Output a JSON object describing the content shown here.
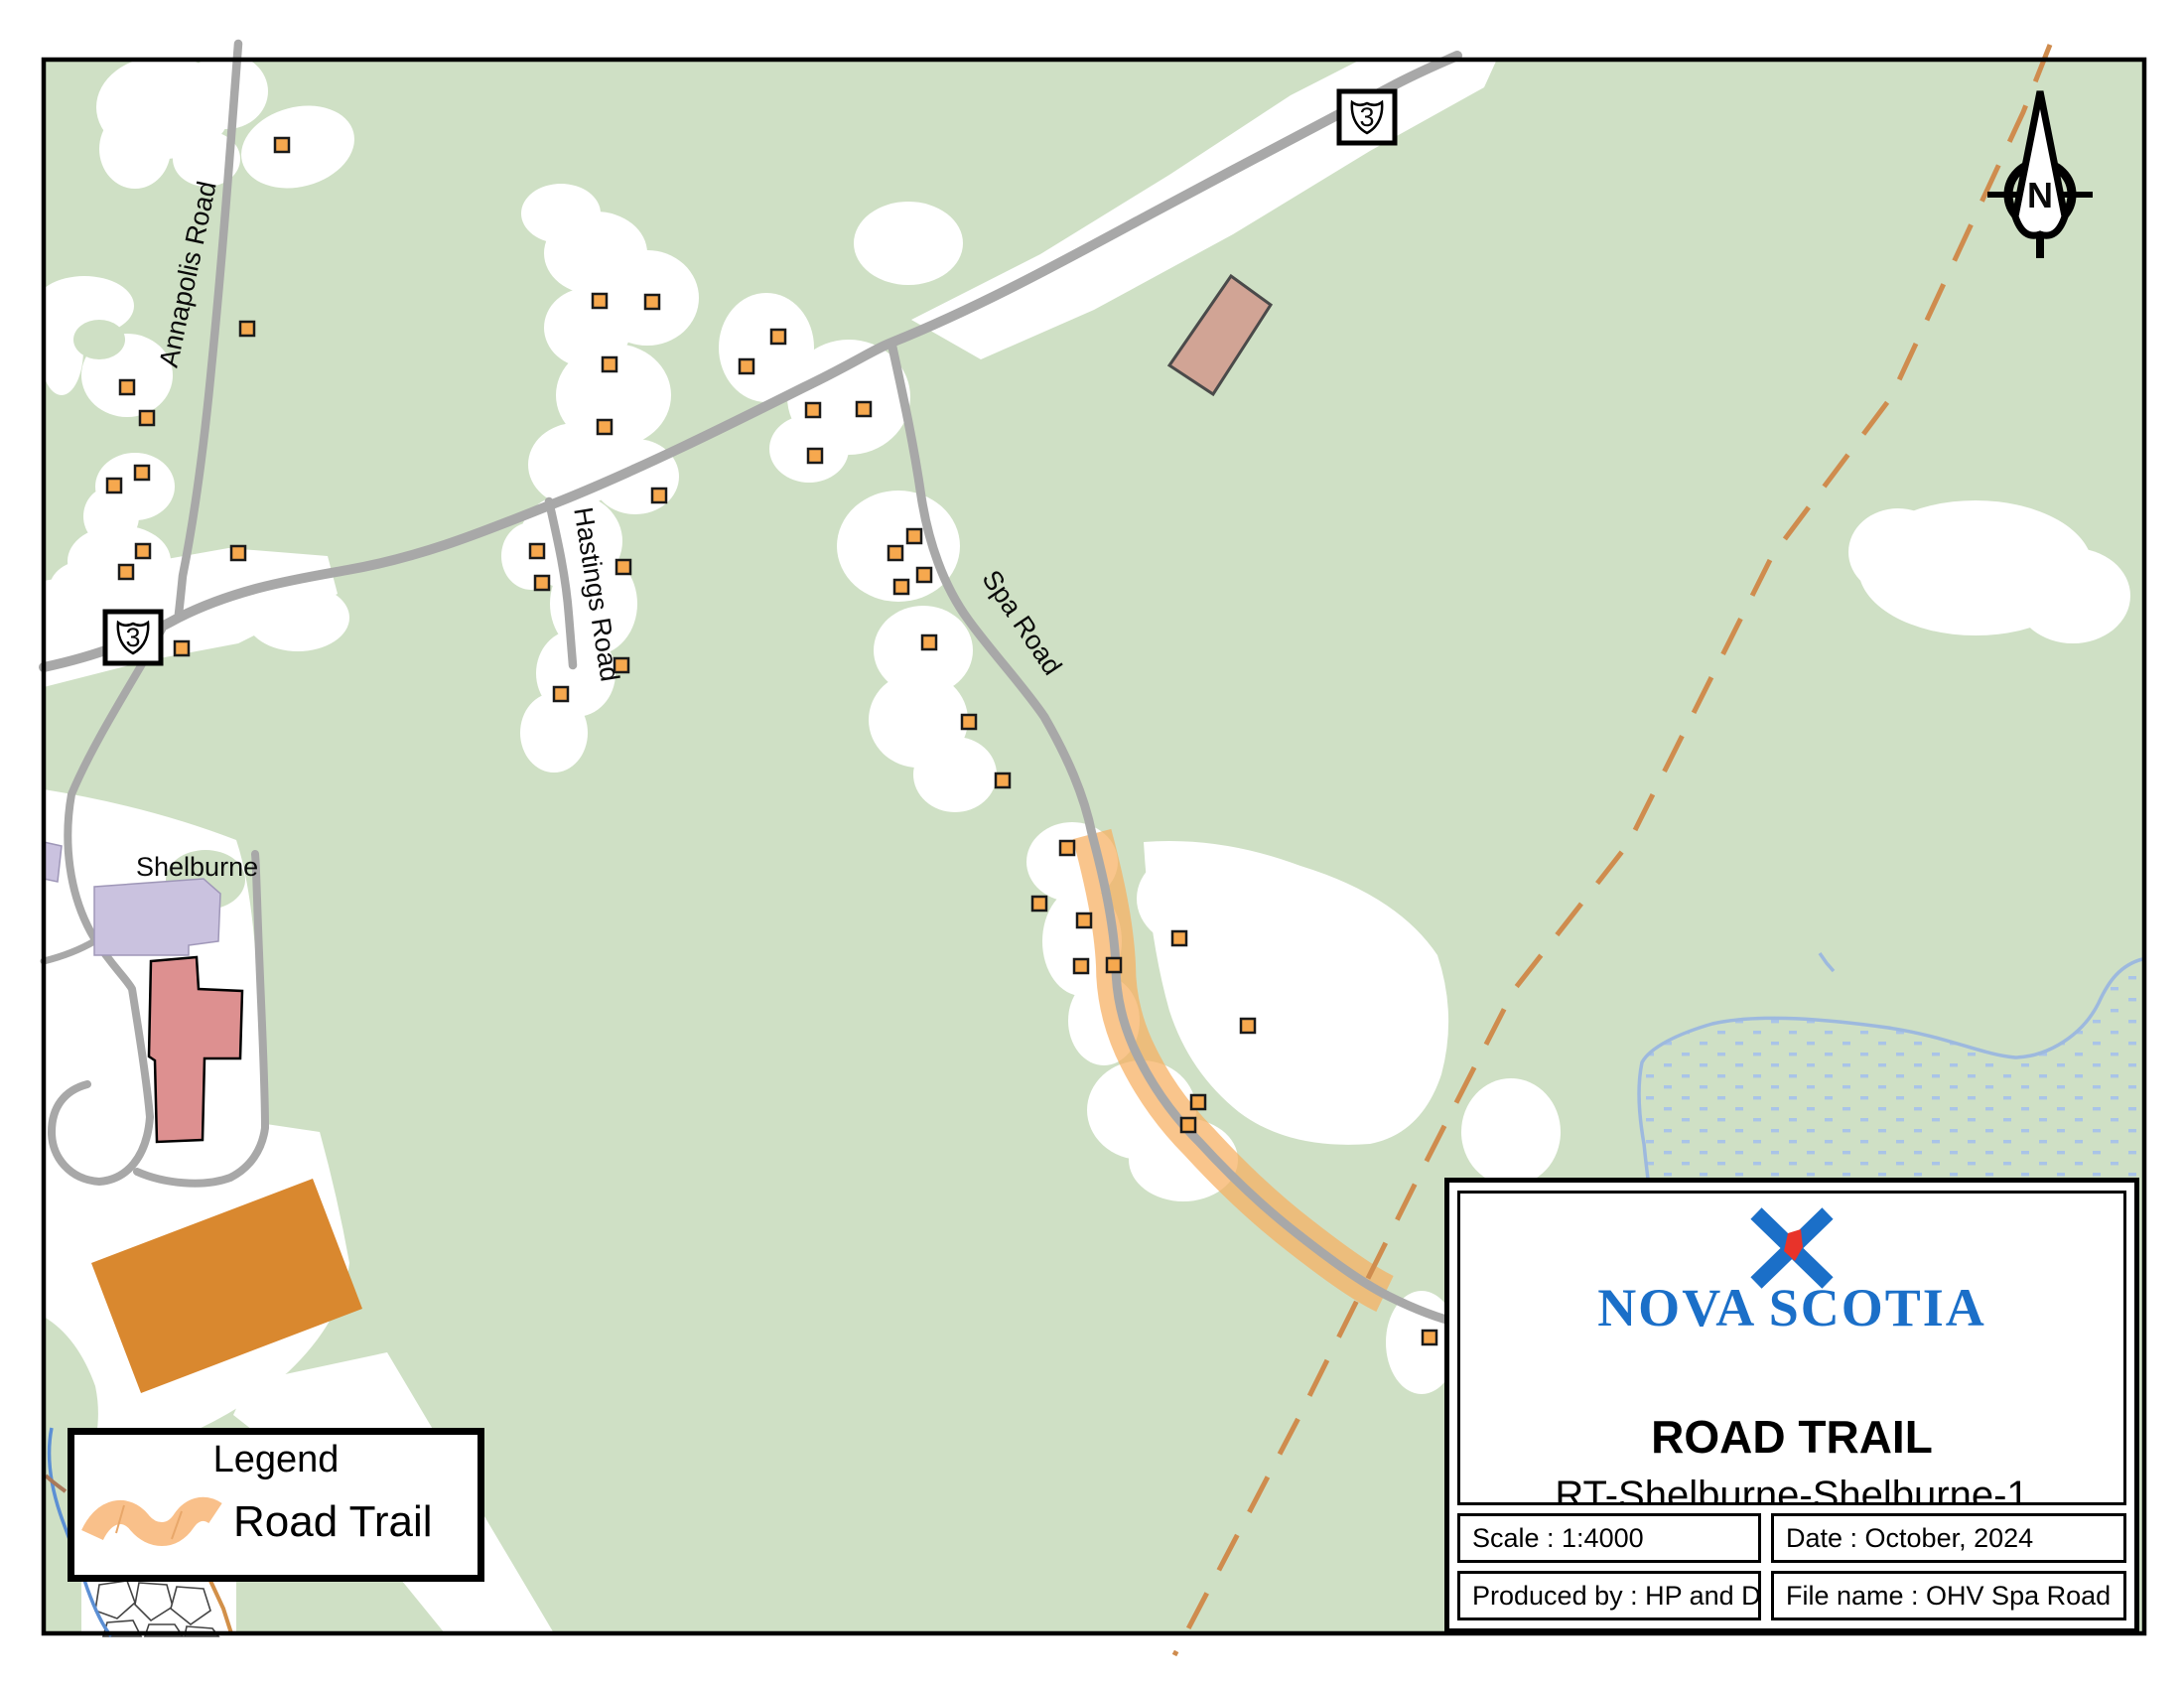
{
  "map": {
    "labels": {
      "annapolis_road": "Annapolis Road",
      "hastings_road": "Hastings Road",
      "spa_road": "Spa Road",
      "shelburne": "Shelburne"
    },
    "highway_shield": "3",
    "north_indicator": "N",
    "buildings": [
      [
        284,
        146
      ],
      [
        249,
        331
      ],
      [
        128,
        390
      ],
      [
        148,
        421
      ],
      [
        143,
        476
      ],
      [
        115,
        489
      ],
      [
        144,
        555
      ],
      [
        127,
        576
      ],
      [
        240,
        557
      ],
      [
        183,
        653
      ],
      [
        604,
        303
      ],
      [
        657,
        304
      ],
      [
        614,
        367
      ],
      [
        609,
        430
      ],
      [
        664,
        499
      ],
      [
        541,
        555
      ],
      [
        546,
        587
      ],
      [
        628,
        571
      ],
      [
        626,
        670
      ],
      [
        565,
        699
      ],
      [
        784,
        339
      ],
      [
        752,
        369
      ],
      [
        819,
        413
      ],
      [
        870,
        412
      ],
      [
        821,
        459
      ],
      [
        921,
        540
      ],
      [
        902,
        557
      ],
      [
        931,
        579
      ],
      [
        908,
        591
      ],
      [
        936,
        647
      ],
      [
        976,
        727
      ],
      [
        1010,
        786
      ],
      [
        1075,
        854
      ],
      [
        1047,
        910
      ],
      [
        1092,
        927
      ],
      [
        1089,
        973
      ],
      [
        1122,
        972
      ],
      [
        1188,
        945
      ],
      [
        1257,
        1033
      ],
      [
        1207,
        1110
      ],
      [
        1197,
        1133
      ],
      [
        1440,
        1347
      ]
    ]
  },
  "legend": {
    "title": "Legend",
    "items": [
      {
        "label": "Road Trail",
        "symbol": "road-trail-line",
        "color": "#f9c08a"
      }
    ]
  },
  "title_block": {
    "logo_text": "NOVA SCOTIA",
    "title": "ROAD TRAIL",
    "subtitle": "RT-Shelburne-Shelburne-1",
    "scale": "Scale : 1:4000",
    "date": "Date : October, 2024",
    "produced_by": "Produced by : HP and D",
    "file_name": "File name : OHV Spa Road"
  },
  "colors": {
    "vegetation_green": "#cfe0c5",
    "cleared_white": "#ffffff",
    "road_gray": "#a8a8a8",
    "trail_orange": "#f6ae5f",
    "building_orange": "#f6a84e",
    "boundary_dash_orange": "#cf8c4e",
    "field_orange": "#d9882f",
    "building_pink": "#dd9090",
    "building_purple": "#cac2df",
    "building_tan": "#d1a495",
    "water_blue": "#9db9de",
    "logo_blue": "#1b6fc8",
    "logo_red": "#e8332a"
  }
}
